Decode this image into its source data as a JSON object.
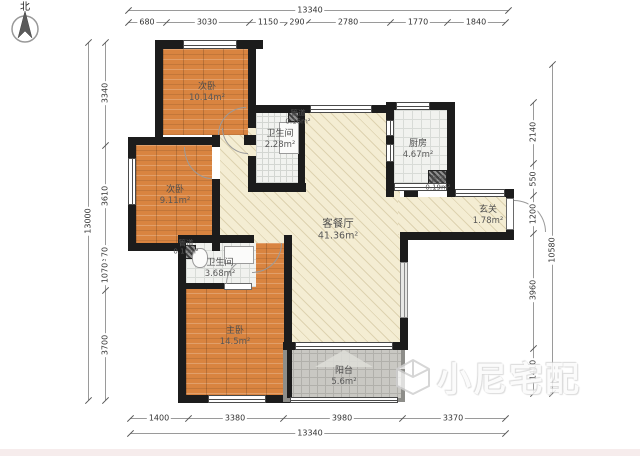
{
  "compass": {
    "label": "北"
  },
  "watermark": {
    "text": "小尼宅配"
  },
  "rooms": {
    "bedroom1": {
      "name": "次卧",
      "area": "10.14m²"
    },
    "bedroom2": {
      "name": "次卧",
      "area": "9.11m²"
    },
    "bath1": {
      "name": "卫生间",
      "area": "2.28m²"
    },
    "duct_top": {
      "name": "管道",
      "area": "0.16m²"
    },
    "kitchen": {
      "name": "厨房",
      "area": "4.67m²"
    },
    "duct_kitchen": {
      "name": "管道",
      "area": "0.19m²"
    },
    "living": {
      "name": "客餐厅",
      "area": "41.36m²"
    },
    "entry": {
      "name": "玄关",
      "area": "1.78m²"
    },
    "duct_left": {
      "name": "管道",
      "area": "0.16m²"
    },
    "bath2": {
      "name": "卫生间",
      "area": "3.68m²"
    },
    "master": {
      "name": "主卧",
      "area": "14.5m²"
    },
    "balcony": {
      "name": "阳台",
      "area": "5.6m²"
    }
  },
  "dimensions": {
    "top": {
      "total": "13340",
      "segments": [
        "680",
        "3030",
        "1150",
        "290",
        "2780",
        "1770",
        "1840"
      ]
    },
    "bottom": {
      "total": "13340",
      "segments": [
        "1400",
        "3380",
        "3980",
        "3370"
      ]
    },
    "left": {
      "total": "13000",
      "segments": [
        "3340",
        "3610",
        "70",
        "1070",
        "3700"
      ]
    },
    "right": {
      "total": "10580",
      "segments": [
        "2140",
        "550",
        "1200",
        "3960",
        "1410"
      ]
    }
  },
  "colors": {
    "wall": "#1c1c1c",
    "wood": "#d98440",
    "living": "#f4edd3",
    "tile": "#f1f2ef",
    "balcony_tile": "#c9c8c3"
  }
}
